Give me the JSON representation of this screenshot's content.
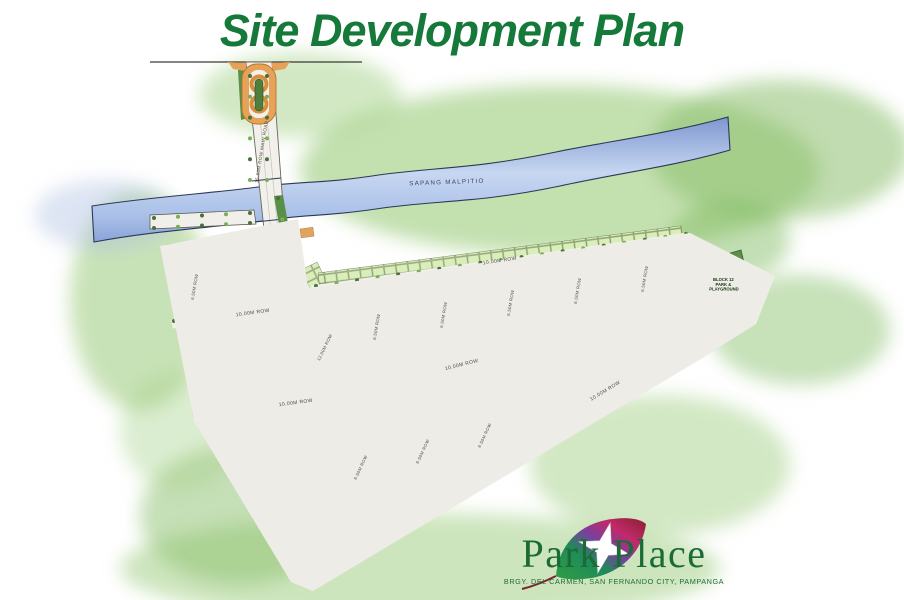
{
  "title": "Site Development Plan",
  "river": {
    "label": "SAPANG MALPITIO"
  },
  "roads": {
    "main": "15.00M ROW MAIN ROAD",
    "spine": "12.00M ROW",
    "row10": "10.00M ROW",
    "row65": "6.50M ROW"
  },
  "block12": {
    "l1": "BLOCK 12",
    "l2": "PARK &",
    "l3": "PLAYGROUND"
  },
  "logo": {
    "name": "Park Place",
    "address": "BRGY. DEL CARMEN, SAN FERNANDO CITY, PAMPANGA"
  },
  "colors": {
    "title_green": "#15793a",
    "logo_green": "#1b6b37",
    "river_blue": "#8aa3d8",
    "lot_green": "#daeeb9",
    "open_space_green": "#5d8f47",
    "road_gray": "#f1f0ea",
    "accent_orange": "#e2a45c",
    "boundary_black": "#1c1c1a"
  },
  "site": {
    "strips": [
      [
        190,
        262,
        24,
        50,
        10
      ],
      [
        216,
        256,
        24,
        56,
        10
      ],
      [
        242,
        251,
        24,
        60,
        10
      ],
      [
        262,
        248,
        20,
        58,
        10
      ],
      [
        301,
        270,
        18,
        96,
        -26
      ],
      [
        207,
        332,
        22,
        80,
        2
      ],
      [
        319,
        295,
        24,
        105,
        10
      ],
      [
        353,
        290,
        24,
        102,
        10
      ],
      [
        386,
        286,
        24,
        98,
        10
      ],
      [
        420,
        281,
        24,
        95,
        10
      ],
      [
        453,
        276,
        24,
        92,
        10
      ],
      [
        487,
        272,
        24,
        88,
        10
      ],
      [
        520,
        267,
        24,
        85,
        10
      ],
      [
        554,
        262,
        24,
        82,
        10
      ],
      [
        588,
        258,
        24,
        78,
        10
      ],
      [
        621,
        253,
        24,
        75,
        10
      ],
      [
        655,
        248,
        24,
        72,
        10
      ],
      [
        274,
        424,
        24,
        147,
        -25
      ],
      [
        305,
        416,
        24,
        138,
        -25
      ],
      [
        336,
        408,
        24,
        130,
        -25
      ],
      [
        367,
        400,
        24,
        121,
        -25
      ],
      [
        398,
        392,
        24,
        112,
        -25
      ],
      [
        429,
        385,
        24,
        103,
        -25
      ],
      [
        460,
        377,
        24,
        94,
        -25
      ],
      [
        491,
        369,
        24,
        86,
        -25
      ],
      [
        522,
        361,
        24,
        77,
        -25
      ],
      [
        553,
        354,
        24,
        68,
        -25
      ],
      [
        584,
        346,
        24,
        59,
        -25
      ],
      [
        615,
        338,
        24,
        50,
        -25
      ],
      [
        646,
        330,
        24,
        42,
        -25
      ],
      [
        166,
        245,
        104,
        13,
        -10
      ],
      [
        318,
        273,
        366,
        12,
        -7.4
      ],
      [
        318,
        571,
        438,
        13,
        -30.8
      ],
      [
        164,
        250,
        12,
        170,
        -10
      ],
      [
        203,
        432,
        12,
        173,
        -31
      ],
      [
        692,
        239,
        90,
        12,
        27.5
      ],
      [
        700,
        346,
        54,
        11,
        -32.4
      ]
    ],
    "greens": [
      [
        412,
        310,
        10,
        24,
        10
      ],
      [
        540,
        300,
        10,
        22,
        10
      ],
      [
        470,
        352,
        22,
        10,
        -14
      ],
      [
        600,
        322,
        20,
        10,
        -14
      ]
    ],
    "oranges": [
      [
        398,
        500,
        24,
        10,
        -31
      ],
      [
        516,
        342,
        20,
        11,
        -14
      ],
      [
        234,
        406,
        16,
        9,
        -10
      ],
      [
        300,
        229,
        13,
        9,
        -8
      ],
      [
        688,
        294,
        12,
        9,
        -34
      ]
    ]
  }
}
